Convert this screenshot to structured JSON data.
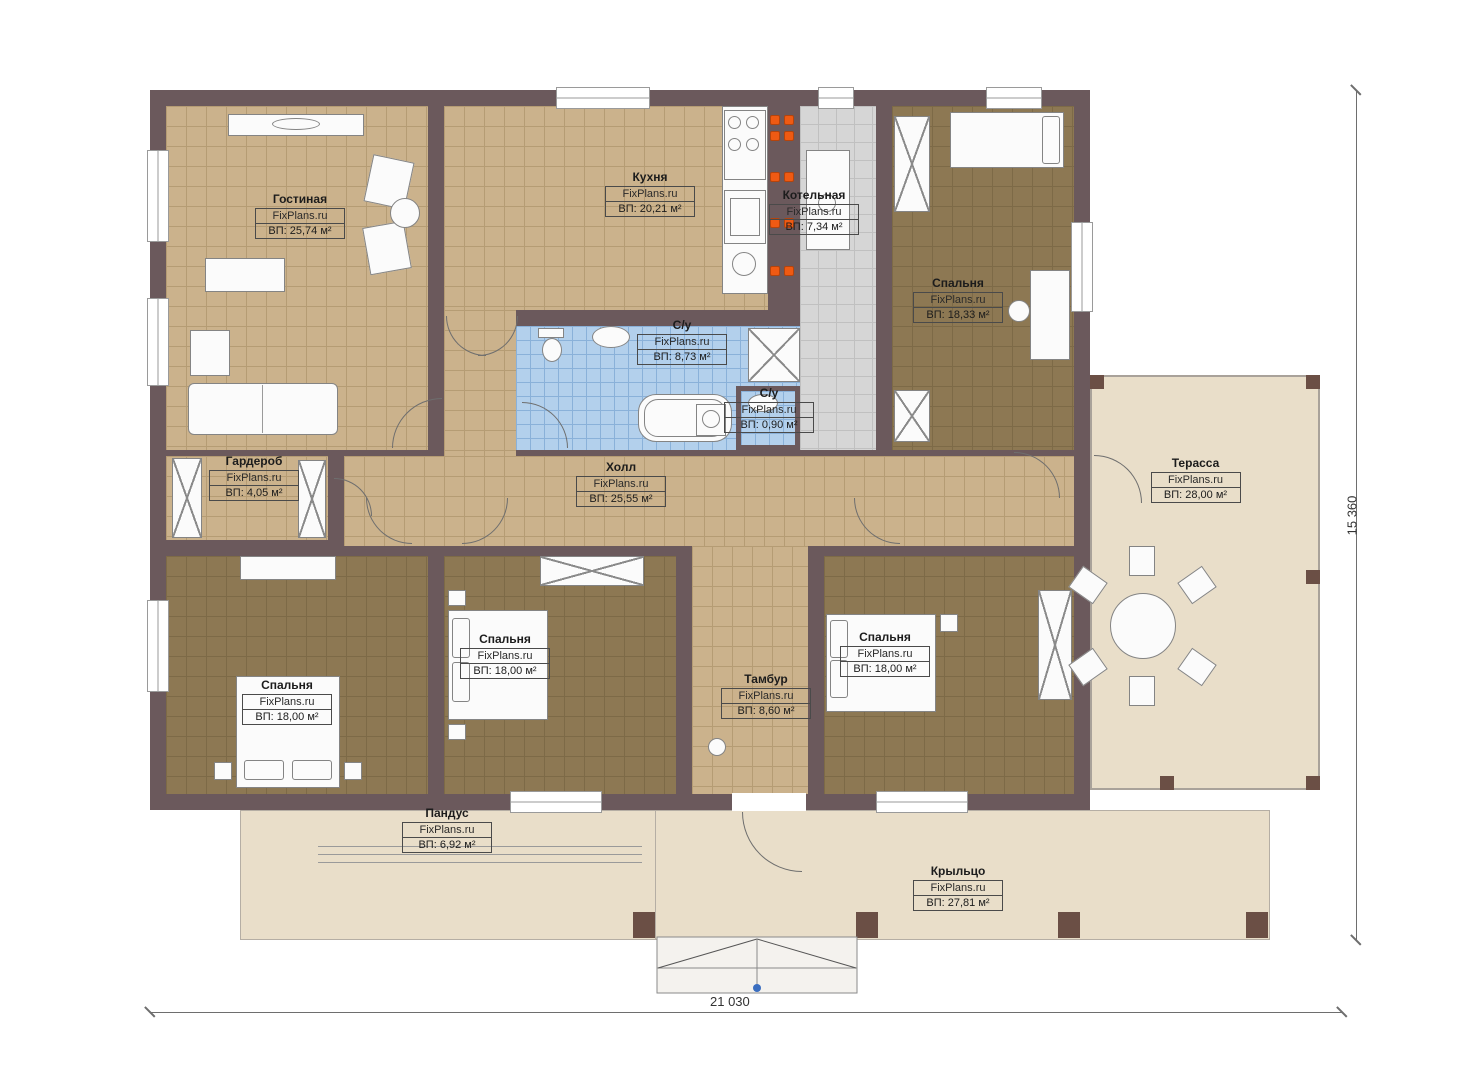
{
  "meta": {
    "brand": "FixPlans.ru",
    "type": "floor-plan"
  },
  "dimensions": {
    "width_label": "21 030",
    "height_label": "15 360"
  },
  "rooms": [
    {
      "id": "living",
      "name": "Гостиная",
      "area": "ВП: 25,74 м²"
    },
    {
      "id": "kitchen",
      "name": "Кухня",
      "area": "ВП: 20,21 м²"
    },
    {
      "id": "boiler",
      "name": "Котельная",
      "area": "ВП: 7,34 м²"
    },
    {
      "id": "bedroom-tr",
      "name": "Спальня",
      "area": "ВП: 18,33 м²"
    },
    {
      "id": "bath-main",
      "name": "С/у",
      "area": "ВП: 8,73 м²"
    },
    {
      "id": "bath-small",
      "name": "С/у",
      "area": "ВП: 0,90 м²"
    },
    {
      "id": "wardrobe",
      "name": "Гардероб",
      "area": "ВП: 4,05 м²"
    },
    {
      "id": "hall",
      "name": "Холл",
      "area": "ВП: 25,55 м²"
    },
    {
      "id": "terrace",
      "name": "Терасса",
      "area": "ВП: 28,00 м²"
    },
    {
      "id": "bedroom-bl",
      "name": "Спальня",
      "area": "ВП: 18,00 м²"
    },
    {
      "id": "bedroom-bm",
      "name": "Спальня",
      "area": "ВП: 18,00 м²"
    },
    {
      "id": "bedroom-br",
      "name": "Спальня",
      "area": "ВП: 18,00 м²"
    },
    {
      "id": "tambour",
      "name": "Тамбур",
      "area": "ВП: 8,60 м²"
    },
    {
      "id": "ramp",
      "name": "Пандус",
      "area": "ВП: 6,92 м²"
    },
    {
      "id": "porch",
      "name": "Крыльцо",
      "area": "ВП: 27,81 м²"
    }
  ],
  "colors": {
    "wall": "#6b595c",
    "floor_tan": "#cbb28c",
    "floor_bedroom": "#8d7853",
    "floor_bath": "#b3d0ec",
    "floor_boiler": "#d6d6d6",
    "surface_beige": "#e9dec9",
    "burner_orange": "#ef5a13",
    "marker_blue": "#3a6ec0"
  }
}
